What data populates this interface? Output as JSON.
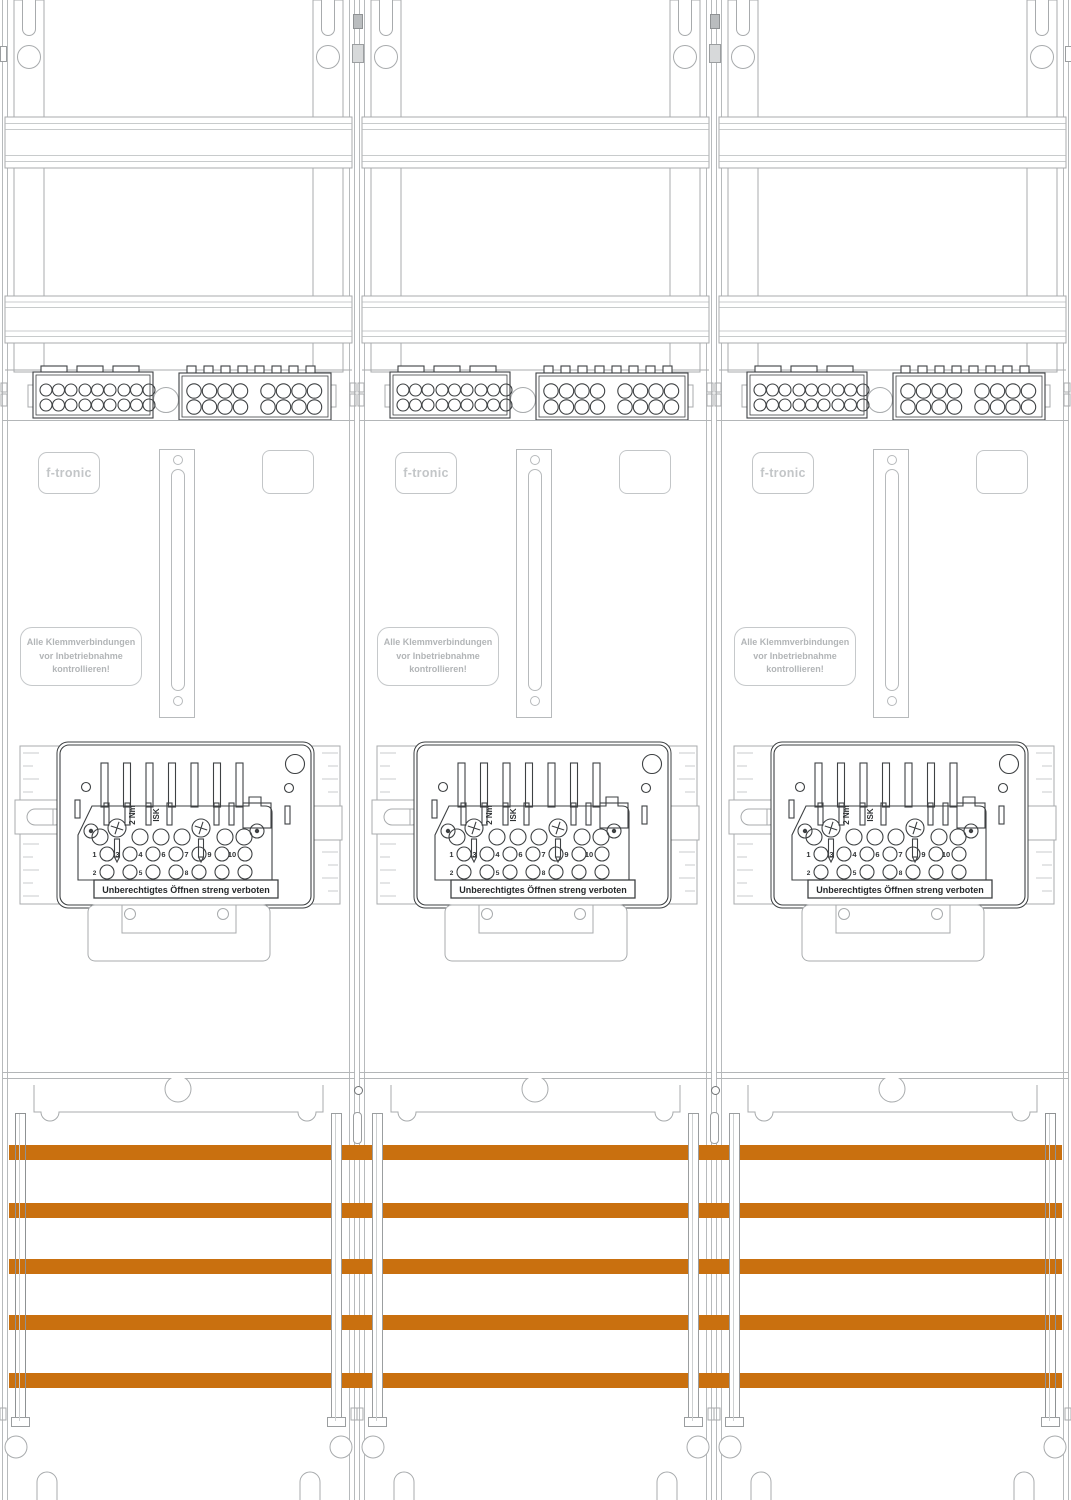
{
  "colors": {
    "orange": "#c9700f",
    "line_gray": "#b3b6b8",
    "dark_line": "#3e4143",
    "label_gray": "#b2b5b7"
  },
  "panel_count": 3,
  "panel": {
    "brand": "f-tronic",
    "warning_lines": [
      "Alle Klemmverbindungen",
      "vor Inbetriebnahme",
      "kontrollieren!"
    ],
    "device": {
      "torque_label": "2 Nm",
      "isk_label": "ISK",
      "banner": "Unberechtigtes Öffnen streng verboten",
      "scale_top": [
        "1",
        "2",
        "3"
      ],
      "scale_bottom": [
        "7",
        "8",
        "9"
      ],
      "terminals_row1": [
        "1",
        "3",
        "4",
        "6",
        "7",
        "9",
        "10"
      ],
      "terminals_row2": [
        "2",
        "5",
        "8"
      ]
    }
  },
  "busbars": {
    "count": 5,
    "color": "#c9700f"
  }
}
